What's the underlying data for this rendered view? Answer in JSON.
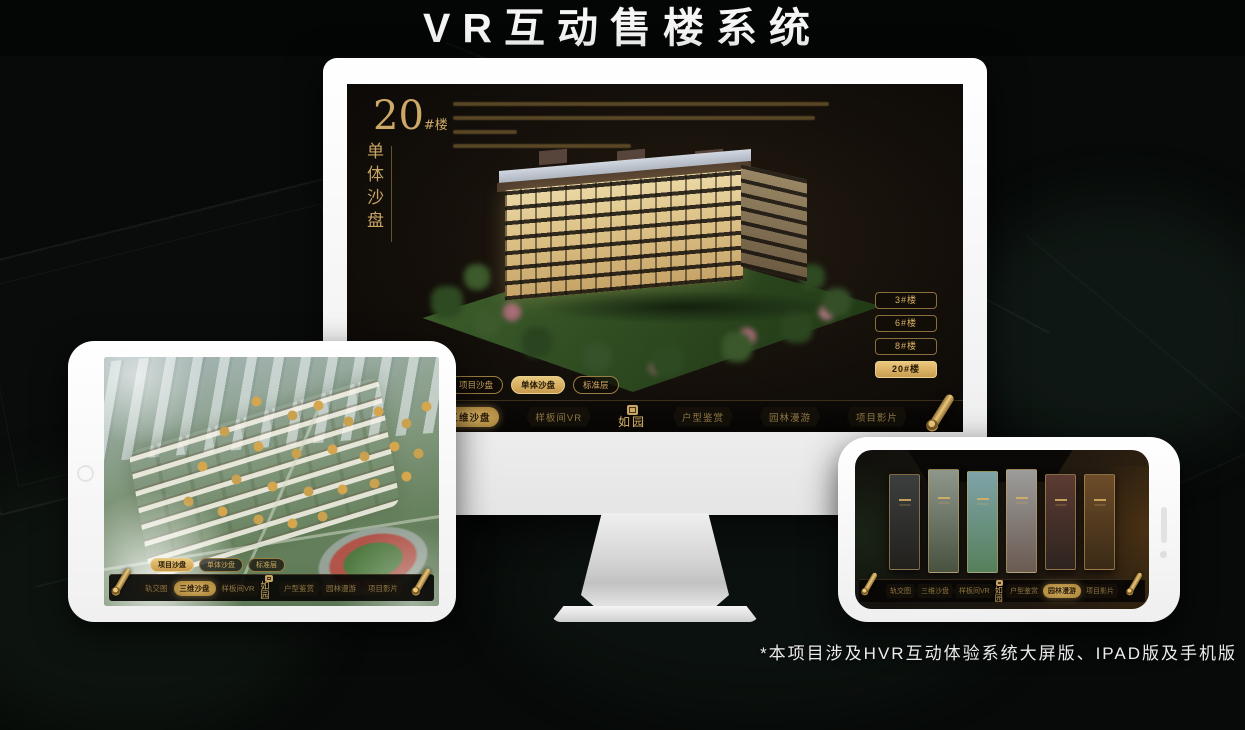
{
  "page": {
    "title": "VR互动售楼系统",
    "footnote": "*本项目涉及HVR互动体验系统大屏版、IPAD版及手机版"
  },
  "brand": {
    "logo_text": "如园",
    "accent_gold": "#c9a565",
    "accent_gold_bright": "#e8c87c",
    "nav_text_color": "#8f7643"
  },
  "desktop_screen": {
    "heading": {
      "number": "20",
      "suffix": "#楼",
      "subtitle_vertical": "单体沙盘"
    },
    "view_tabs": [
      {
        "label": "项目沙盘",
        "active": false
      },
      {
        "label": "单体沙盘",
        "active": true
      },
      {
        "label": "标准层",
        "active": false
      }
    ],
    "building_buttons": [
      {
        "label": "3#楼",
        "active": false
      },
      {
        "label": "6#楼",
        "active": false
      },
      {
        "label": "8#楼",
        "active": false
      },
      {
        "label": "20#楼",
        "active": true
      }
    ],
    "menu": [
      {
        "label": "轨交图",
        "active": false
      },
      {
        "label": "三维沙盘",
        "active": true
      },
      {
        "label": "样板间VR",
        "active": false
      },
      {
        "label": "户型鉴赏",
        "active": false
      },
      {
        "label": "园林漫游",
        "active": false
      },
      {
        "label": "项目影片",
        "active": false
      }
    ]
  },
  "tablet_screen": {
    "view_tabs": [
      {
        "label": "项目沙盘",
        "active": true
      },
      {
        "label": "单体沙盘",
        "active": false
      },
      {
        "label": "标准层",
        "active": false
      }
    ],
    "menu": [
      {
        "label": "轨交图",
        "active": false
      },
      {
        "label": "三维沙盘",
        "active": true
      },
      {
        "label": "样板间VR",
        "active": false
      },
      {
        "label": "户型鉴赏",
        "active": false
      },
      {
        "label": "园林漫游",
        "active": false
      },
      {
        "label": "项目影片",
        "active": false
      }
    ]
  },
  "phone_screen": {
    "gallery_panel_count": 6,
    "menu": [
      {
        "label": "轨交图",
        "active": false
      },
      {
        "label": "三维沙盘",
        "active": false
      },
      {
        "label": "样板间VR",
        "active": false
      },
      {
        "label": "户型鉴赏",
        "active": false
      },
      {
        "label": "园林漫游",
        "active": true
      },
      {
        "label": "项目影片",
        "active": false
      }
    ]
  }
}
